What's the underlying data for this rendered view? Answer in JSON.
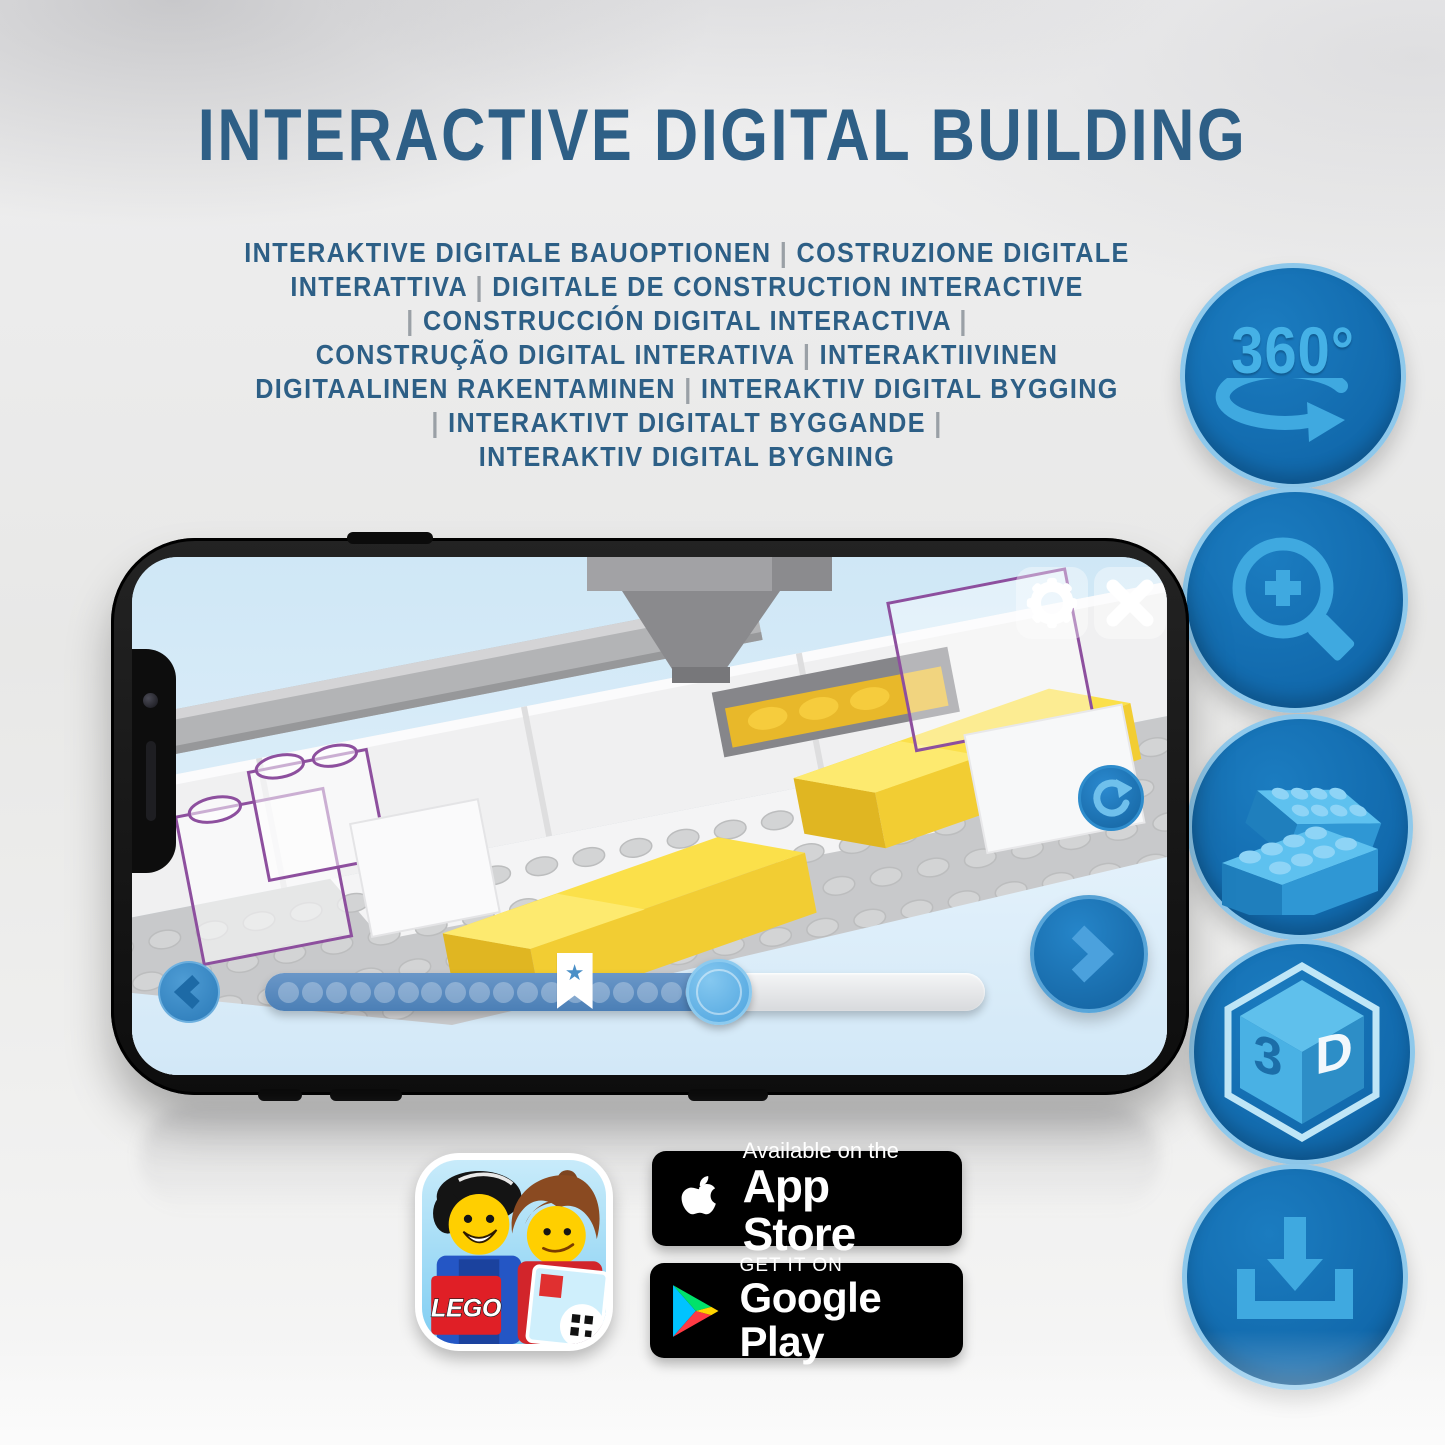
{
  "title": "INTERACTIVE DIGITAL BUILDING",
  "subtitle_lines": [
    "INTERAKTIVE DIGITALE BAUOPTIONEN | COSTRUZIONE DIGITALE",
    "INTERATTIVA | DIGITALE DE CONSTRUCTION INTERACTIVE",
    "| CONSTRUCCIÓN DIGITAL INTERACTIVA |",
    "CONSTRUÇÃO DIGITAL INTERATIVA | INTERAKTIIVINEN",
    "DIGITAALINEN RAKENTAMINEN | INTERAKTIV DIGITAL BYGGING",
    "| INTERAKTIVT DIGITALT BYGGANDE |",
    "INTERAKTIV DIGITAL BYGNING"
  ],
  "features": {
    "rotation_label": "360°",
    "cube_left": "3",
    "cube_right": "D"
  },
  "phone_app": {
    "slider": {
      "dots": 18,
      "progress_percent": 63,
      "bookmark_percent": 43,
      "star_glyph": "★"
    }
  },
  "store": {
    "lego_logo_text": "LEGO",
    "app_store": {
      "line1": "Available on the",
      "line2": "App Store"
    },
    "google_play": {
      "line1": "GET IT ON",
      "line2": "Google Play"
    }
  },
  "colors": {
    "title_blue": "#2e5f86",
    "icon_circle_blue": "#1470b4",
    "icon_glyph_blue": "#3fa9e0",
    "brick_yellow": "#f2cf35",
    "ghost_outline_purple": "#8d4f9e",
    "app_button_blue": "#1e7abf"
  }
}
